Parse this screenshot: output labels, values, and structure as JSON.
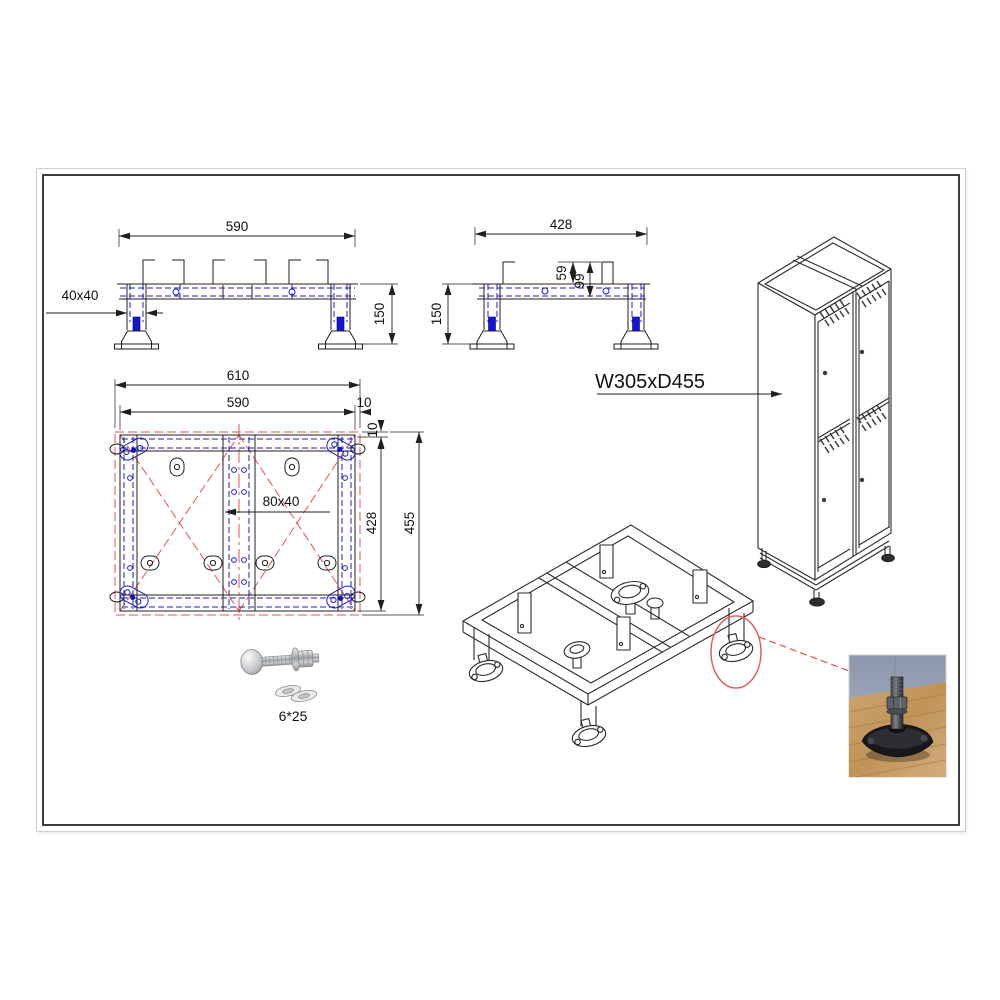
{
  "front_view": {
    "dim_width": "590",
    "dim_height": "150",
    "leg_profile": "40x40"
  },
  "side_view": {
    "dim_width": "428",
    "dim_height": "150",
    "dim_bracket": "59",
    "dim_bracket_total": "99"
  },
  "plan_view": {
    "dim_overall_width": "610",
    "dim_frame_width": "590",
    "dim_side_gap": "10",
    "dim_top_gap": "10",
    "dim_frame_depth": "428",
    "dim_overall_depth": "455",
    "center_rail_profile": "80x40"
  },
  "cabinet_view": {
    "size_label": "W305xD455"
  },
  "fastener_view": {
    "bolt_size": "6*25"
  },
  "colors": {
    "line": "#1f1f1f",
    "hidden_blue": "#1d1dca",
    "foot_blue": "#1414d2",
    "red": "#e85050"
  }
}
